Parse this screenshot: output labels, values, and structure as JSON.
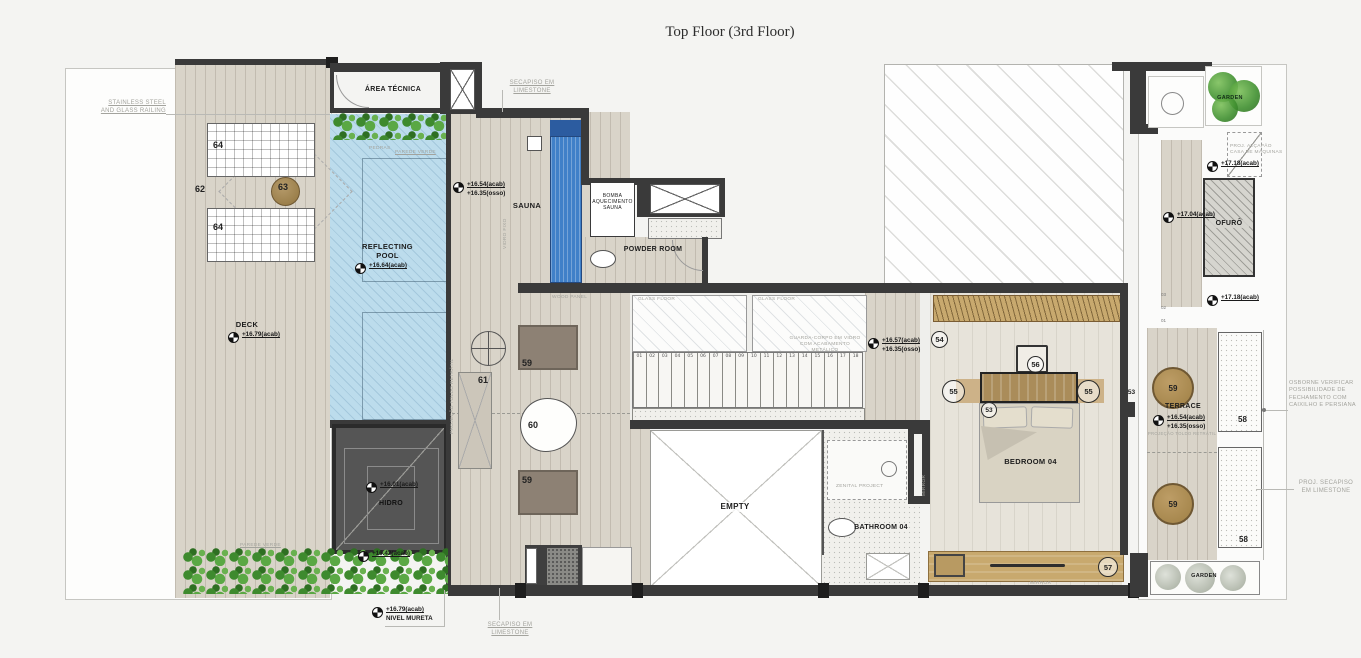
{
  "colors": {
    "wall": "#3a3a3a",
    "pool": "#bcdcec",
    "deck": "#d9d4c9",
    "wood": "#c8a96e",
    "green": "#4c9a38",
    "paper": "#f4f4f2",
    "note_gray": "#a3a39d",
    "sauna_pool_blue": "#4080c8"
  },
  "title": "Top Floor (3rd Floor)",
  "notes": {
    "railing": "STAINLESS STEEL\nAND GLASS RAILING",
    "secapiso_top": "SECAPISO EM\nLIMESTONE",
    "secapiso_bottom": "SECAPISO EM\nLIMESTONE",
    "proj_secapiso": "PROJ. SECAPISO\nEM LIMESTONE",
    "osborne": "OSBORNE VERIFICAR\nPOSSIBILIDADE DE\nFECHAMENTO COM\nCAIXILHO E PERSIANA",
    "proj_alcapao": "PROJ. ALÇAPÃO\nCASA DE MÁQUINAS",
    "guarda_corpo": "GUARDA-CORPO EM VIDRO\nCOM ACABAMENTO METÁLICO",
    "wood_panel": "WOOD PANEL",
    "glass_floor": "GLASS FLOOR",
    "pedras": "PEDRAS",
    "parede_verde": "PAREDE VERDE",
    "vidro_fixo": "VIDRO FIXO",
    "proj_toldo": "PROJEÇÃO TOLDO RETRÁTIL",
    "zenital": "ZENITAL PROJECT",
    "mirror": "MIRROR",
    "nivel_mureta": "NIVEL MURETA"
  },
  "rooms": {
    "area_tecnica": "ÁREA TÉCNICA",
    "sauna": "SAUNA",
    "bomba": "BOMBA\nAQUECIMENTO\nSAUNA",
    "powder": "POWDER ROOM",
    "pool": "REFLECTING\nPOOL",
    "deck": "DECK",
    "hidro": "HIDRO",
    "empty": "EMPTY",
    "bathroom": "BATHROOM 04",
    "bedroom": "BEDROOM 04",
    "terrace": "TERRACE",
    "ofuro": "OFURÔ",
    "garden_top": "GARDEN",
    "garden_bottom": "GARDEN"
  },
  "levels": {
    "pool": "+16.64(acab)",
    "deck": "+16.79(acab)",
    "sauna_acab": "+16.54(acab)",
    "sauna_osso": "+16.35(osso)",
    "stair_acab": "+16.57(acab)",
    "stair_osso": "+16.35(osso)",
    "terrace_acab": "+16.54(acab)",
    "terrace_osso": "+16.35(osso)",
    "hidro_top": "+16.01(acab)",
    "hidro_bottom": "+16.42(acab)",
    "mureta": "+16.79(acab)",
    "alcapao": "+17.18(acab)",
    "ofuro_a": "+17.04(acab)",
    "ofuro_b": "+17.18(acab)"
  },
  "numbers": {
    "n62": "62",
    "n63": "63",
    "n64a": "64",
    "n64b": "64",
    "n53a": "53",
    "n53b": "53",
    "n54": "54",
    "n55a": "55",
    "n55b": "55",
    "n56": "56",
    "n57": "57",
    "n58a": "58",
    "n58b": "58",
    "n59a": "59",
    "n59b": "59",
    "n59c": "59",
    "n59d": "59",
    "n60": "60",
    "n61": "61"
  },
  "shaft_marks": [
    "03",
    "02",
    "01"
  ],
  "stairs": [
    "01",
    "02",
    "03",
    "04",
    "05",
    "06",
    "07",
    "08",
    "09",
    "10",
    "11",
    "12",
    "13",
    "14",
    "15",
    "16",
    "17",
    "18"
  ]
}
